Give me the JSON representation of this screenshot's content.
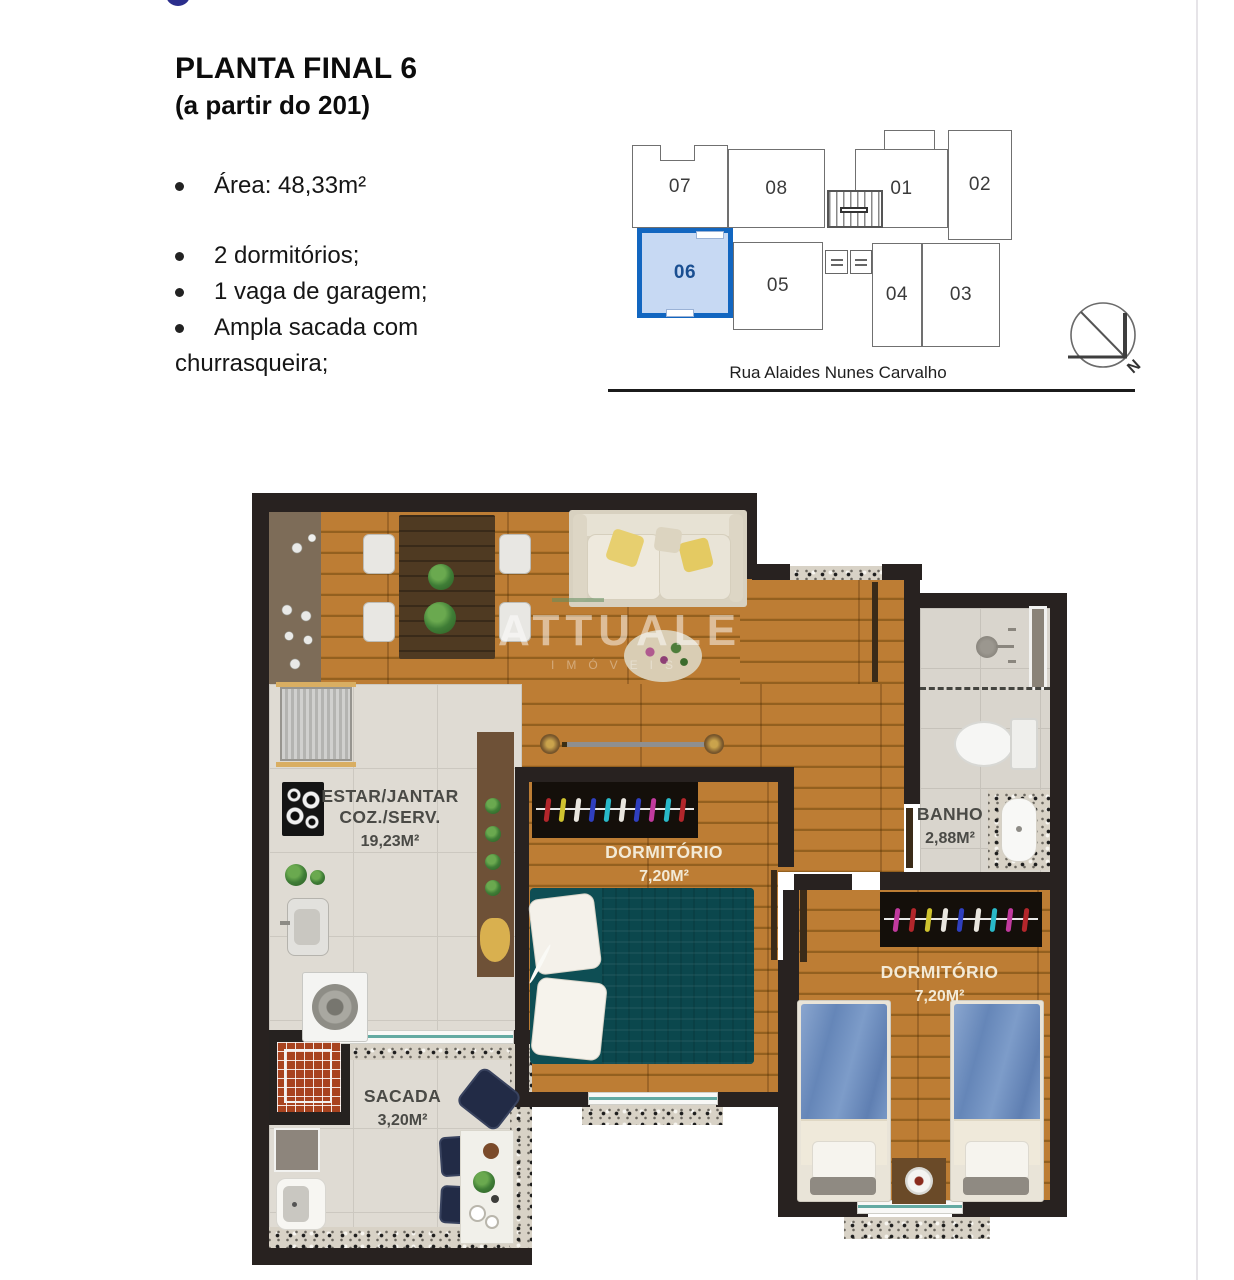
{
  "header": {
    "title": "PLANTA FINAL 6",
    "subtitle": "(a partir do 201)",
    "features": [
      "Área: 48,33m²",
      "2 dormitórios;",
      "1 vaga de garagem;",
      "Ampla sacada com churrasqueira;"
    ]
  },
  "key_plan": {
    "units": [
      {
        "label": "07",
        "highlighted": false
      },
      {
        "label": "08",
        "highlighted": false
      },
      {
        "label": "01",
        "highlighted": false
      },
      {
        "label": "02",
        "highlighted": false
      },
      {
        "label": "06",
        "highlighted": true
      },
      {
        "label": "05",
        "highlighted": false
      },
      {
        "label": "04",
        "highlighted": false
      },
      {
        "label": "03",
        "highlighted": false
      }
    ],
    "street": "Rua Alaides Nunes Carvalho",
    "north_label": "N",
    "highlight_border": "#1266c0",
    "highlight_fill": "#c7d9f3"
  },
  "floor_plan": {
    "watermark": {
      "line1": "ATTUALE",
      "line2": "IMÓVEIS"
    },
    "rooms": {
      "living": {
        "line1": "ESTAR/JANTAR",
        "line2": "COZ./SERV.",
        "area": "19,23M²"
      },
      "dorm1": {
        "name": "DORMITÓRIO",
        "area": "7,20M²"
      },
      "banho": {
        "name": "BANHO",
        "area": "2,88M²"
      },
      "dorm2": {
        "name": "DORMITÓRIO",
        "area": "7,20M²"
      },
      "sacada": {
        "name": "SACADA",
        "area": "3,20M²"
      }
    }
  },
  "colors": {
    "wall": "#282220",
    "wood": "#b5752e",
    "tile": "#dfdbd3",
    "bed_teal": "#0e4e54",
    "bed_blue": "#7194c4",
    "highlight_blue": "#1266c0"
  }
}
